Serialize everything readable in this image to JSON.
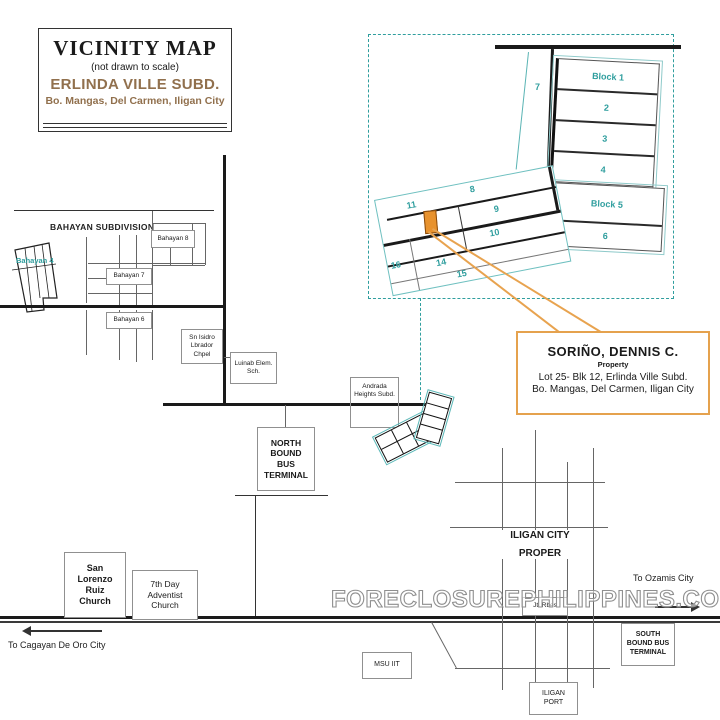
{
  "header": {
    "title": "VICINITY MAP",
    "scale_note": "(not drawn to scale)",
    "subdivision": "ERLINDA VILLE SUBD.",
    "address": "Bo. Mangas, Del Carmen, Iligan City"
  },
  "inset": {
    "block1": "Block 1",
    "lot2": "2",
    "lot3": "3",
    "lot4": "4",
    "block5": "Block 5",
    "lot6": "6",
    "lot7": "7",
    "lot8": "8",
    "lot9": "9",
    "lot10": "10",
    "lot11": "11",
    "lot14": "14",
    "lot15": "15",
    "lot16": "16"
  },
  "callout": {
    "owner": "SORIÑO, DENNIS C.",
    "type_label": "Property",
    "address_line1": "Lot 25- Blk 12, Erlinda Ville Subd.",
    "address_line2": "Bo. Mangas, Del Carmen, Iligan City"
  },
  "bahayan": {
    "title": "BAHAYAN SUBDIVISION",
    "street_8": "Bahayan 8",
    "street_7": "Bahayan 7",
    "street_6": "Bahayan 6",
    "area_4": "Bahayan 4"
  },
  "landmarks": {
    "chapel": "Sn Isidro Lbrador Chpel",
    "school": "Luinab Elem. Sch.",
    "andrada": "Andrada Heights Subd.",
    "north_terminal": "NORTH BOUND BUS TERMINAL",
    "san_lorenzo": "San Lorenzo Ruiz Church",
    "adventist": "7th Day Adventist Church",
    "msu": "MSU IIT",
    "port": "ILIGAN PORT",
    "south_terminal": "SOUTH BOUND BUS TERMINAL",
    "jt_rbes": "Jt. Rbes"
  },
  "city": {
    "proper_line1": "ILIGAN CITY",
    "proper_line2": "PROPER"
  },
  "directions": {
    "to_cdo": "To Cagayan De Oro City",
    "to_ozamis": "To Ozamis City"
  },
  "watermark": "FORECLOSUREPHILIPPINES.COM",
  "colors": {
    "teal_accent": "#2f9e9e",
    "orange_highlight": "#e8922d",
    "brown_title": "#91704d",
    "watermark_gray": "#8f8f8f"
  }
}
